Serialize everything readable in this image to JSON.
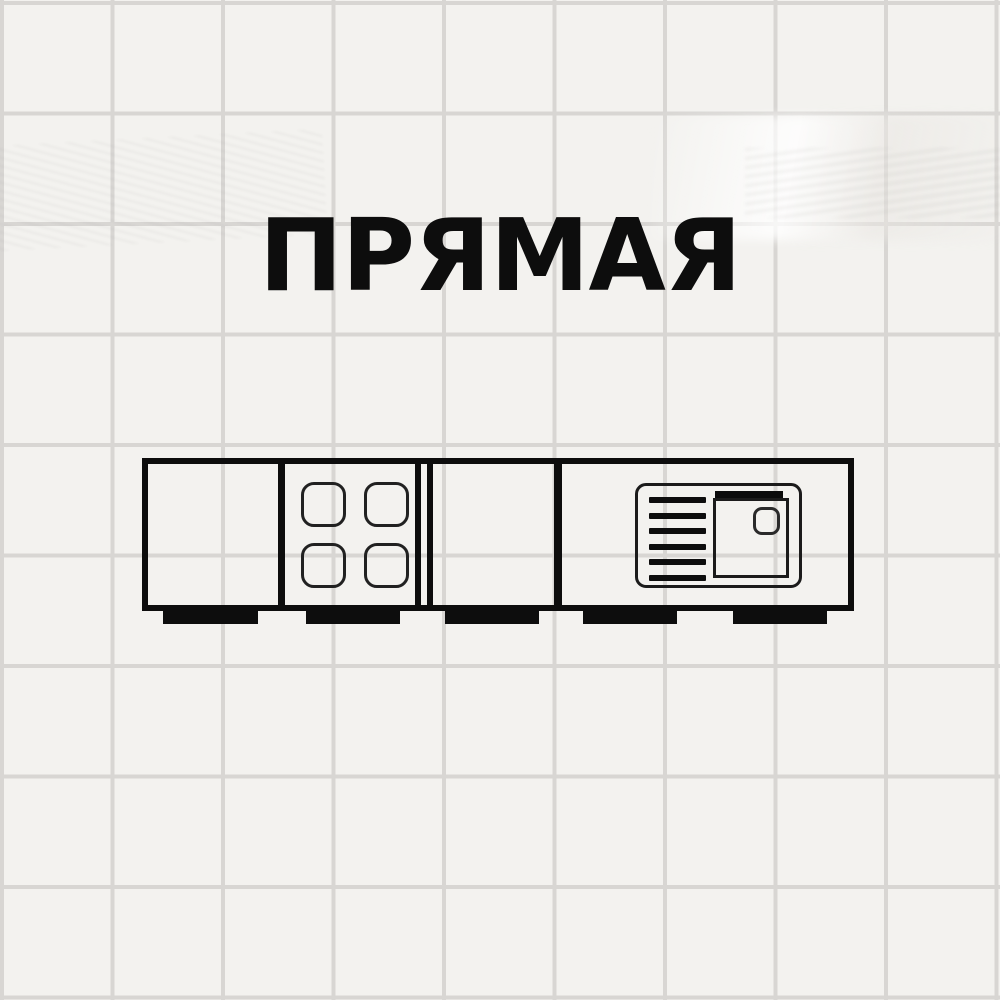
{
  "title": "ПРЯМАЯ",
  "colors": {
    "ink": "#0d0d0d",
    "paper": "#f3f2ef",
    "grid_line": "#d8d6d3"
  },
  "diagram": {
    "type": "kitchen-layout",
    "layout_name": "straight-line",
    "modules": [
      {
        "name": "base-cabinet"
      },
      {
        "name": "cooktop",
        "burners": 4
      },
      {
        "name": "base-cabinet"
      },
      {
        "name": "sink-counter",
        "drainer_lines": 6,
        "basins": 1,
        "drain_holes": 1
      }
    ],
    "feet": 5
  }
}
